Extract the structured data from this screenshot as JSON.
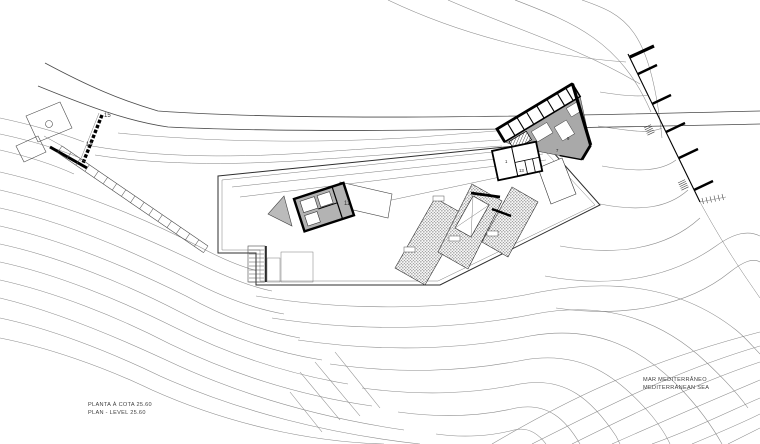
{
  "drawing": {
    "title": {
      "line1": "PLANTA À COTA 25.60",
      "line2": "PLAN - LEVEL 25.60"
    },
    "sea": {
      "line1": "MAR MEDITERRÂNEO",
      "line2": "MEDITERRANEAN SEA"
    },
    "site_labels": {
      "road": "15",
      "upper_path": "14",
      "roof_terrace": "11"
    },
    "room_numbers": {
      "n1": "1",
      "n13": "13",
      "n7": "7",
      "n9": "9"
    },
    "colors": {
      "background": "#ffffff",
      "line": "#4a4a4a",
      "contour": "#8a8a8a",
      "wall": "#000000",
      "building_fill": "#a9a9a9",
      "pavilion_fill": "#b3b3b3",
      "stipple": "#3d3d3d",
      "text": "#3f3f3f"
    }
  }
}
